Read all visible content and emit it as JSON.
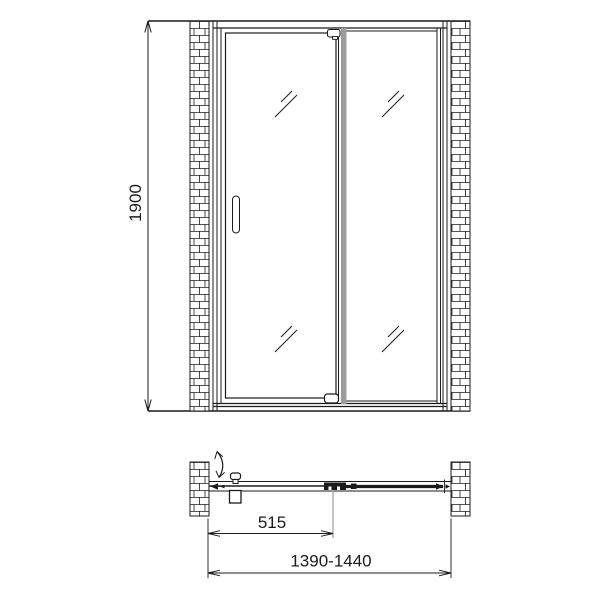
{
  "colors": {
    "background": "#ffffff",
    "line": "#1b1b1b",
    "profile": "#9c9c9c"
  },
  "front_view": {
    "height_dim_label": "1900"
  },
  "plan_view": {
    "door_pivot_offset_label": "515",
    "overall_width_label": "1390-1440"
  }
}
